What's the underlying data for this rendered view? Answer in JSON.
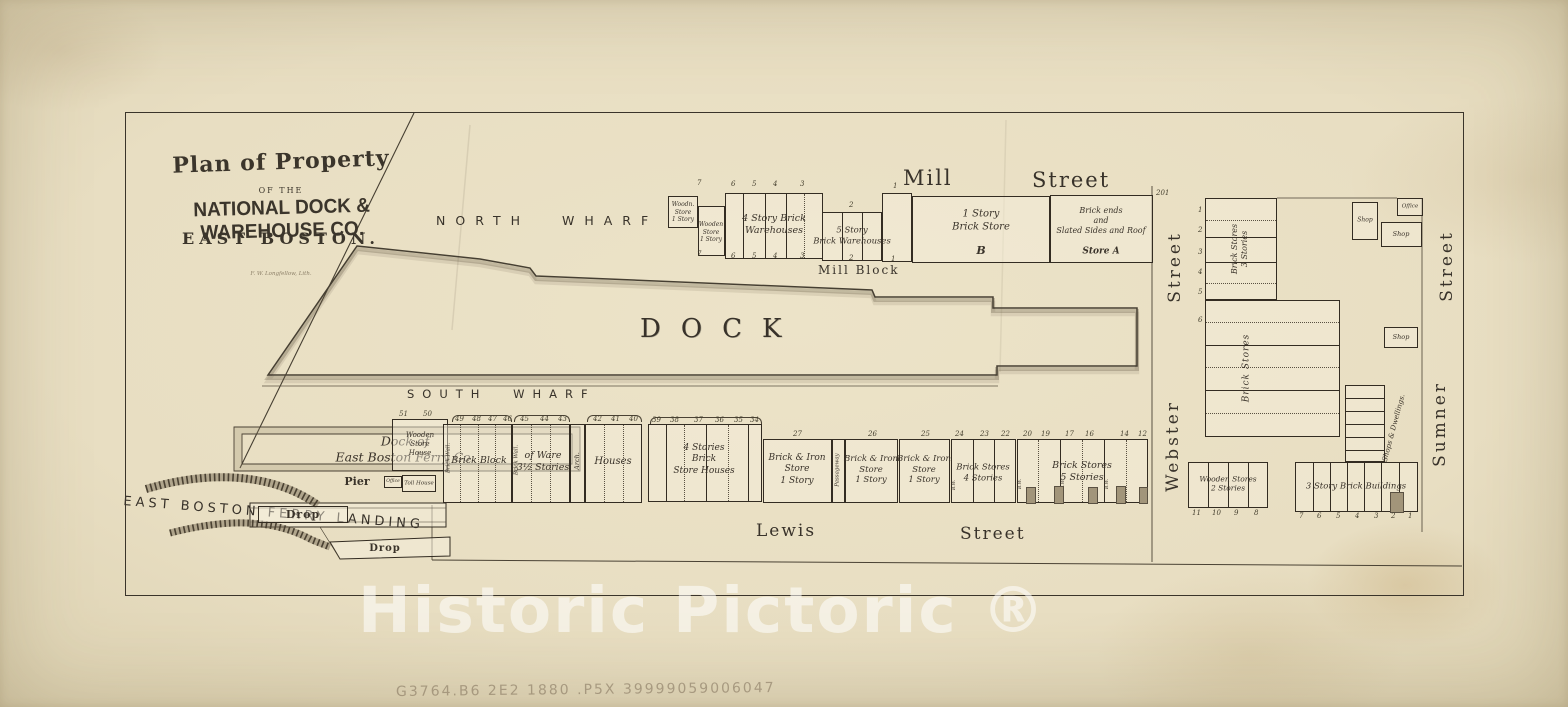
{
  "colors": {
    "paper": "#e8dec2",
    "ink": "#332c22",
    "line": "#4a4234",
    "watermark": "rgba(255,255,255,0.55)",
    "pencil": "rgba(125,110,88,0.55)"
  },
  "title_block": {
    "line1": "Plan of Property",
    "line2": "OF THE",
    "line3": "NATIONAL DOCK & WAREHOUSE CO.",
    "line4": "EAST BOSTON.",
    "imprint": "F. W. Longfellow, Lith."
  },
  "labels": {
    "north_wharf": "NORTH WHARF",
    "dock": "DOCK",
    "south_wharf": "SOUTH WHARF",
    "mill": "Mill",
    "mill_street": "Street",
    "mill_block": "Mill Block",
    "lewis": "Lewis",
    "lewis_street": "Street",
    "webster": "Webster",
    "webster_street": "Street",
    "sumner": "Sumner",
    "sumner_street": "Street"
  },
  "ferry": {
    "dock_of": "Dock of\nEast Boston Ferry Co.",
    "pier": "Pier",
    "landing": "EAST BOSTON FERRY LANDING",
    "drop1": "Drop",
    "drop2": "Drop",
    "office": "Office",
    "toll": "Toll House"
  },
  "mill_row": {
    "b1": "Woodn.\nStore\n1 Story",
    "b2": "Wooden\nStore\n1 Story",
    "b3": "4 Story Brick\nWarehouses",
    "b4": "5 Story\nBrick Warehouses",
    "b5": "1 Story\nBrick Store",
    "b5_letter": "B",
    "b6": "Brick ends\nand\nSlated Sides and Roof",
    "b6_letter": "Store A"
  },
  "south_row": {
    "wsh": "Wooden\nStore\nHouse",
    "brick_wall": "Brick Wall.",
    "brick_block": "Brick Block",
    "of_ware": "of Ware\n3½ Stories",
    "arch": "Arch.",
    "houses": "Houses",
    "four_stories": "4 Stories\nBrick\nStore Houses",
    "store27": "Brick & Iron\nStore\n1 Story",
    "passageway": "Passageway",
    "store26": "Brick & Iron\nStore\n1 Story",
    "store25": "Brick & Iron\nStore\n1 Story",
    "bs4": "Brick Stores\n4 Stories",
    "bs5": "Brick Stores\n5 Stories",
    "bw": "B.W."
  },
  "right_block": {
    "ref": "201",
    "bs3": "Brick Stores\n3 Stories",
    "brick_stores": "Brick Stores",
    "shop": "Shop",
    "office": "Office",
    "shops_dwellings": "Shops & Dwellings.",
    "wooden_stores": "Wooden Stores\n2 Stories",
    "brick3": "3 Story Brick Buildings"
  },
  "lot_numbers": [
    {
      "t": "7",
      "x": 697,
      "y": 179
    },
    {
      "t": "6",
      "x": 731,
      "y": 180
    },
    {
      "t": "5",
      "x": 752,
      "y": 180
    },
    {
      "t": "4",
      "x": 773,
      "y": 180
    },
    {
      "t": "3",
      "x": 800,
      "y": 180
    },
    {
      "t": "2",
      "x": 849,
      "y": 201
    },
    {
      "t": "1",
      "x": 893,
      "y": 182
    },
    {
      "t": "7",
      "x": 697,
      "y": 250
    },
    {
      "t": "6",
      "x": 731,
      "y": 252
    },
    {
      "t": "5",
      "x": 752,
      "y": 252
    },
    {
      "t": "4",
      "x": 773,
      "y": 252
    },
    {
      "t": "3",
      "x": 800,
      "y": 252
    },
    {
      "t": "2",
      "x": 849,
      "y": 254
    },
    {
      "t": "1",
      "x": 891,
      "y": 255
    },
    {
      "t": "51",
      "x": 399,
      "y": 410
    },
    {
      "t": "50",
      "x": 423,
      "y": 410
    },
    {
      "t": "49",
      "x": 455,
      "y": 415
    },
    {
      "t": "48",
      "x": 472,
      "y": 415
    },
    {
      "t": "47",
      "x": 488,
      "y": 415
    },
    {
      "t": "46",
      "x": 503,
      "y": 415
    },
    {
      "t": "45",
      "x": 520,
      "y": 415
    },
    {
      "t": "44",
      "x": 540,
      "y": 415
    },
    {
      "t": "43",
      "x": 558,
      "y": 415
    },
    {
      "t": "42",
      "x": 593,
      "y": 415
    },
    {
      "t": "41",
      "x": 611,
      "y": 415
    },
    {
      "t": "40",
      "x": 629,
      "y": 415
    },
    {
      "t": "39",
      "x": 652,
      "y": 416
    },
    {
      "t": "38",
      "x": 670,
      "y": 416
    },
    {
      "t": "37",
      "x": 694,
      "y": 416
    },
    {
      "t": "36",
      "x": 715,
      "y": 416
    },
    {
      "t": "35",
      "x": 734,
      "y": 416
    },
    {
      "t": "34",
      "x": 750,
      "y": 416
    },
    {
      "t": "27",
      "x": 793,
      "y": 430
    },
    {
      "t": "26",
      "x": 868,
      "y": 430
    },
    {
      "t": "25",
      "x": 921,
      "y": 430
    },
    {
      "t": "24",
      "x": 955,
      "y": 430
    },
    {
      "t": "23",
      "x": 980,
      "y": 430
    },
    {
      "t": "22",
      "x": 1001,
      "y": 430
    },
    {
      "t": "20",
      "x": 1023,
      "y": 430
    },
    {
      "t": "19",
      "x": 1041,
      "y": 430
    },
    {
      "t": "17",
      "x": 1065,
      "y": 430
    },
    {
      "t": "16",
      "x": 1085,
      "y": 430
    },
    {
      "t": "14",
      "x": 1120,
      "y": 430
    },
    {
      "t": "12",
      "x": 1138,
      "y": 430
    },
    {
      "t": "11",
      "x": 1192,
      "y": 509
    },
    {
      "t": "10",
      "x": 1212,
      "y": 509
    },
    {
      "t": "9",
      "x": 1234,
      "y": 509
    },
    {
      "t": "8",
      "x": 1254,
      "y": 509
    },
    {
      "t": "7",
      "x": 1299,
      "y": 512
    },
    {
      "t": "6",
      "x": 1317,
      "y": 512
    },
    {
      "t": "5",
      "x": 1336,
      "y": 512
    },
    {
      "t": "4",
      "x": 1355,
      "y": 512
    },
    {
      "t": "3",
      "x": 1374,
      "y": 512
    },
    {
      "t": "2",
      "x": 1391,
      "y": 512
    },
    {
      "t": "1",
      "x": 1408,
      "y": 512
    },
    {
      "t": "1",
      "x": 1198,
      "y": 206
    },
    {
      "t": "2",
      "x": 1198,
      "y": 226
    },
    {
      "t": "3",
      "x": 1198,
      "y": 248
    },
    {
      "t": "4",
      "x": 1198,
      "y": 268
    },
    {
      "t": "5",
      "x": 1198,
      "y": 288
    },
    {
      "t": "6",
      "x": 1198,
      "y": 316
    },
    {
      "t": "201",
      "x": 1156,
      "y": 189
    }
  ],
  "watermark": "Historic Pictoric ®",
  "pencil_note": "G3764.B6 2E2 1880 .P5X    39999059006047"
}
